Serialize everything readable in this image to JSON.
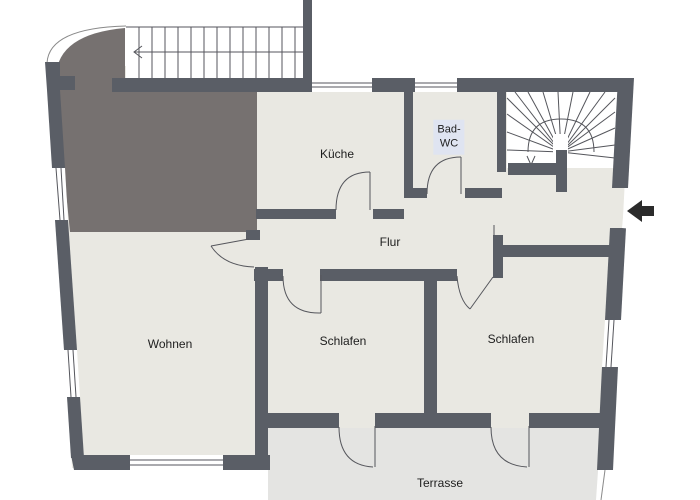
{
  "floorplan": {
    "title": "apartment-floor-plan",
    "rooms": [
      {
        "id": "kueche",
        "label": "Küche"
      },
      {
        "id": "bad_wc",
        "label": "Bad-WC",
        "label_line1": "Bad-",
        "label_line2": "WC"
      },
      {
        "id": "flur",
        "label": "Flur"
      },
      {
        "id": "wohnen",
        "label": "Wohnen"
      },
      {
        "id": "schlafen_1",
        "label": "Schlafen"
      },
      {
        "id": "schlafen_2",
        "label": "Schlafen"
      },
      {
        "id": "terrasse",
        "label": "Terrasse"
      }
    ],
    "features": {
      "straight_staircase": {
        "icon": "stairs-icon",
        "direction_arrow": "left"
      },
      "winder_staircase": {
        "icon": "winder-stairs-icon",
        "direction_arrow": "down"
      },
      "entrance": {
        "icon": "entrance-arrow-icon",
        "direction": "left"
      }
    },
    "colors": {
      "wall": "#5a5e66",
      "dark_area": "#767170",
      "room_fill": "#e9e8e2",
      "terrace_fill": "#e4e4e2",
      "label_bg": "#dfe4f1",
      "line": "#55565c",
      "arrow": "#2b2b2b"
    }
  }
}
